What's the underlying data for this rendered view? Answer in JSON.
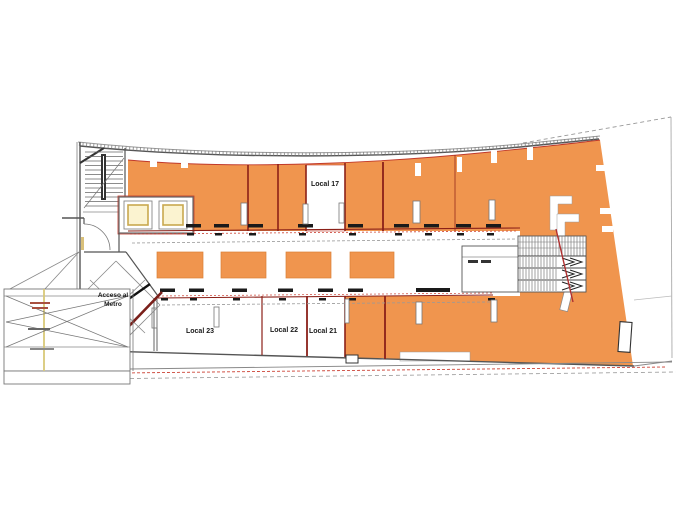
{
  "plan": {
    "type": "commercial-floor-plan",
    "units": [
      {
        "id": "local-17",
        "label": "Local 17",
        "highlighted": false
      },
      {
        "id": "local-23",
        "label": "Local 23",
        "highlighted": false
      },
      {
        "id": "local-22",
        "label": "Local 22",
        "highlighted": false
      },
      {
        "id": "local-21",
        "label": "Local 21",
        "highlighted": false
      }
    ],
    "annotations": {
      "metro_line1": "Acceso al",
      "metro_line2": "Metro"
    },
    "colors": {
      "highlight_orange": "#F0954E",
      "demising_maroon": "#8B2018",
      "dashed_red": "#CC4437",
      "wall_gray": "#555555",
      "elevator_cream": "#FBF3D0",
      "elevator_trim": "#C9A84F"
    }
  }
}
